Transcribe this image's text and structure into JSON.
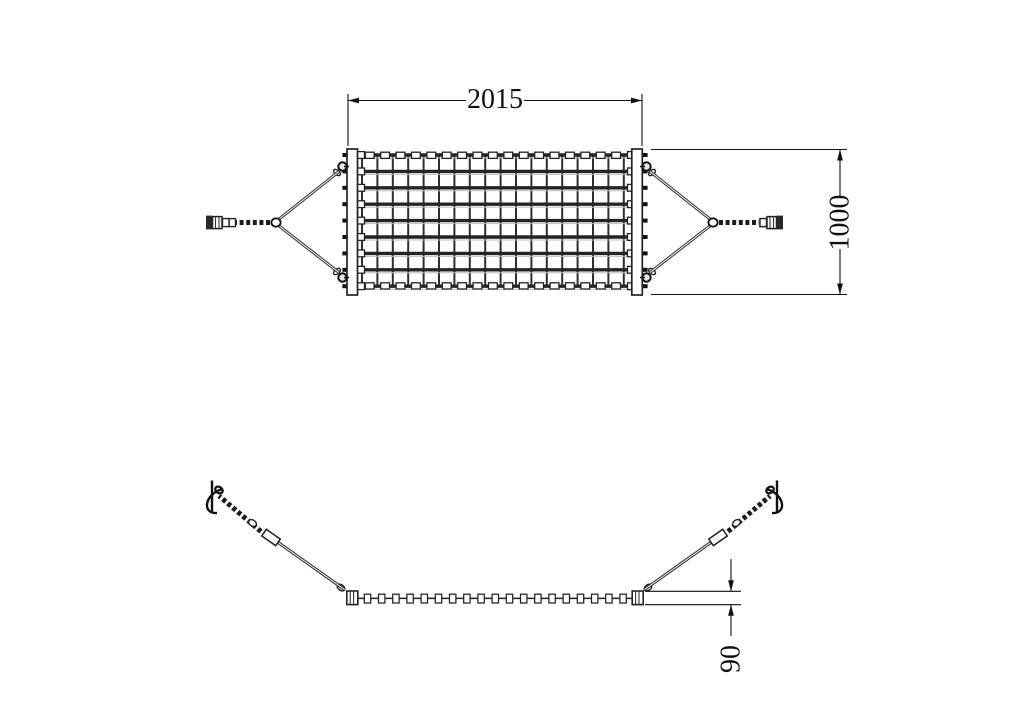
{
  "drawing": {
    "dimensions": {
      "length": "2015",
      "width": "1000",
      "thickness": "90"
    },
    "colors": {
      "background": "#ffffff",
      "line": "#262626",
      "dimension": "#111111"
    },
    "mesh": {
      "vertical_ropes": 18,
      "horizontal_ropes": 9,
      "top_clamps": 17,
      "bottom_clamps": 17,
      "edge_clamps": 19
    }
  }
}
